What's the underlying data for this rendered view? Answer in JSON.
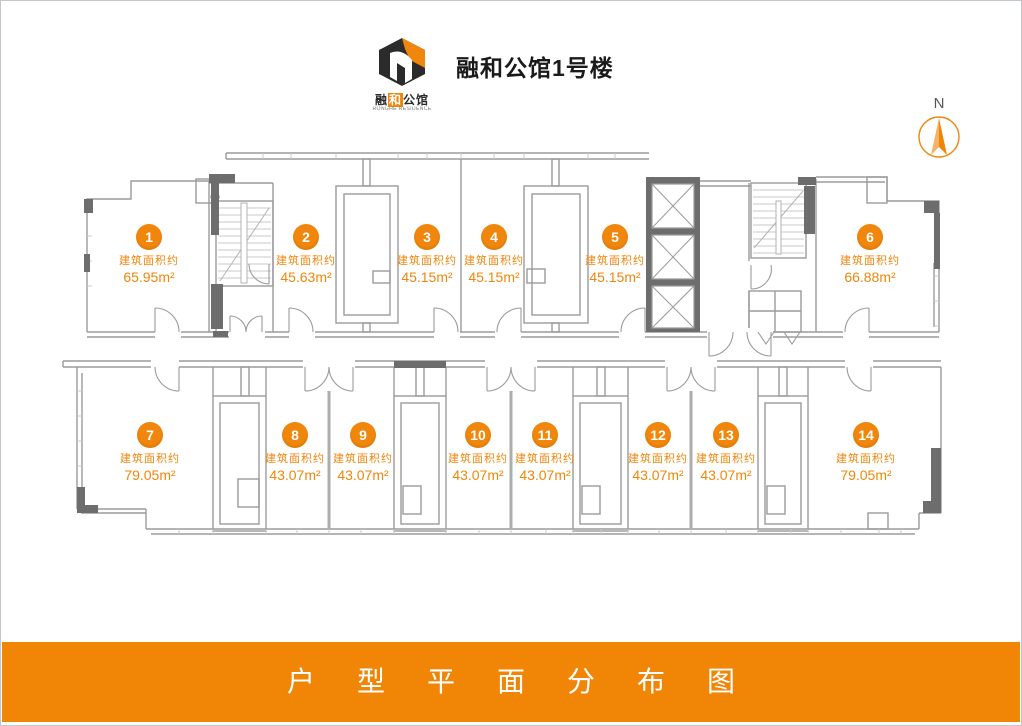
{
  "header": {
    "title": "融和公馆1号楼",
    "logo": {
      "cn_prefix": "融",
      "cn_highlight": "和",
      "cn_suffix": "公馆",
      "en": "RONGHE RESIDENCE"
    }
  },
  "compass": {
    "label": "N"
  },
  "plan": {
    "area_label": "建筑面积约",
    "units": [
      {
        "num": "1",
        "area": "65.95m²"
      },
      {
        "num": "2",
        "area": "45.63m²"
      },
      {
        "num": "3",
        "area": "45.15m²"
      },
      {
        "num": "4",
        "area": "45.15m²"
      },
      {
        "num": "5",
        "area": "45.15m²"
      },
      {
        "num": "6",
        "area": "66.88m²"
      },
      {
        "num": "7",
        "area": "79.05m²"
      },
      {
        "num": "8",
        "area": "43.07m²"
      },
      {
        "num": "9",
        "area": "43.07m²"
      },
      {
        "num": "10",
        "area": "43.07m²"
      },
      {
        "num": "11",
        "area": "43.07m²"
      },
      {
        "num": "12",
        "area": "43.07m²"
      },
      {
        "num": "13",
        "area": "43.07m²"
      },
      {
        "num": "14",
        "area": "79.05m²"
      }
    ]
  },
  "footer": {
    "title": "户型平面分布图"
  },
  "colors": {
    "accent": "#f0860b",
    "banner": "#f18506",
    "wall_dark": "#6d6d6d",
    "wall_light": "#9b9b9b"
  }
}
